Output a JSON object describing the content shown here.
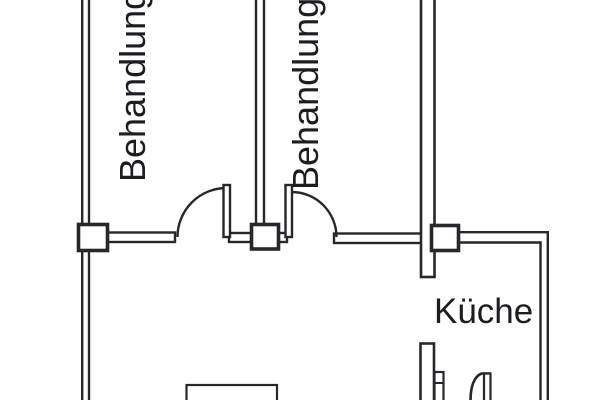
{
  "document": {
    "type": "floor-plan",
    "language": "de"
  },
  "colors": {
    "background": "#ffffff",
    "wall_line": "#27272c",
    "text": "#1c1c21"
  },
  "rooms": {
    "treatment_room_1": {
      "label": "Behandlung"
    },
    "treatment_room_2": {
      "label": "Behandlung"
    },
    "kitchen": {
      "label": "Küche"
    }
  }
}
